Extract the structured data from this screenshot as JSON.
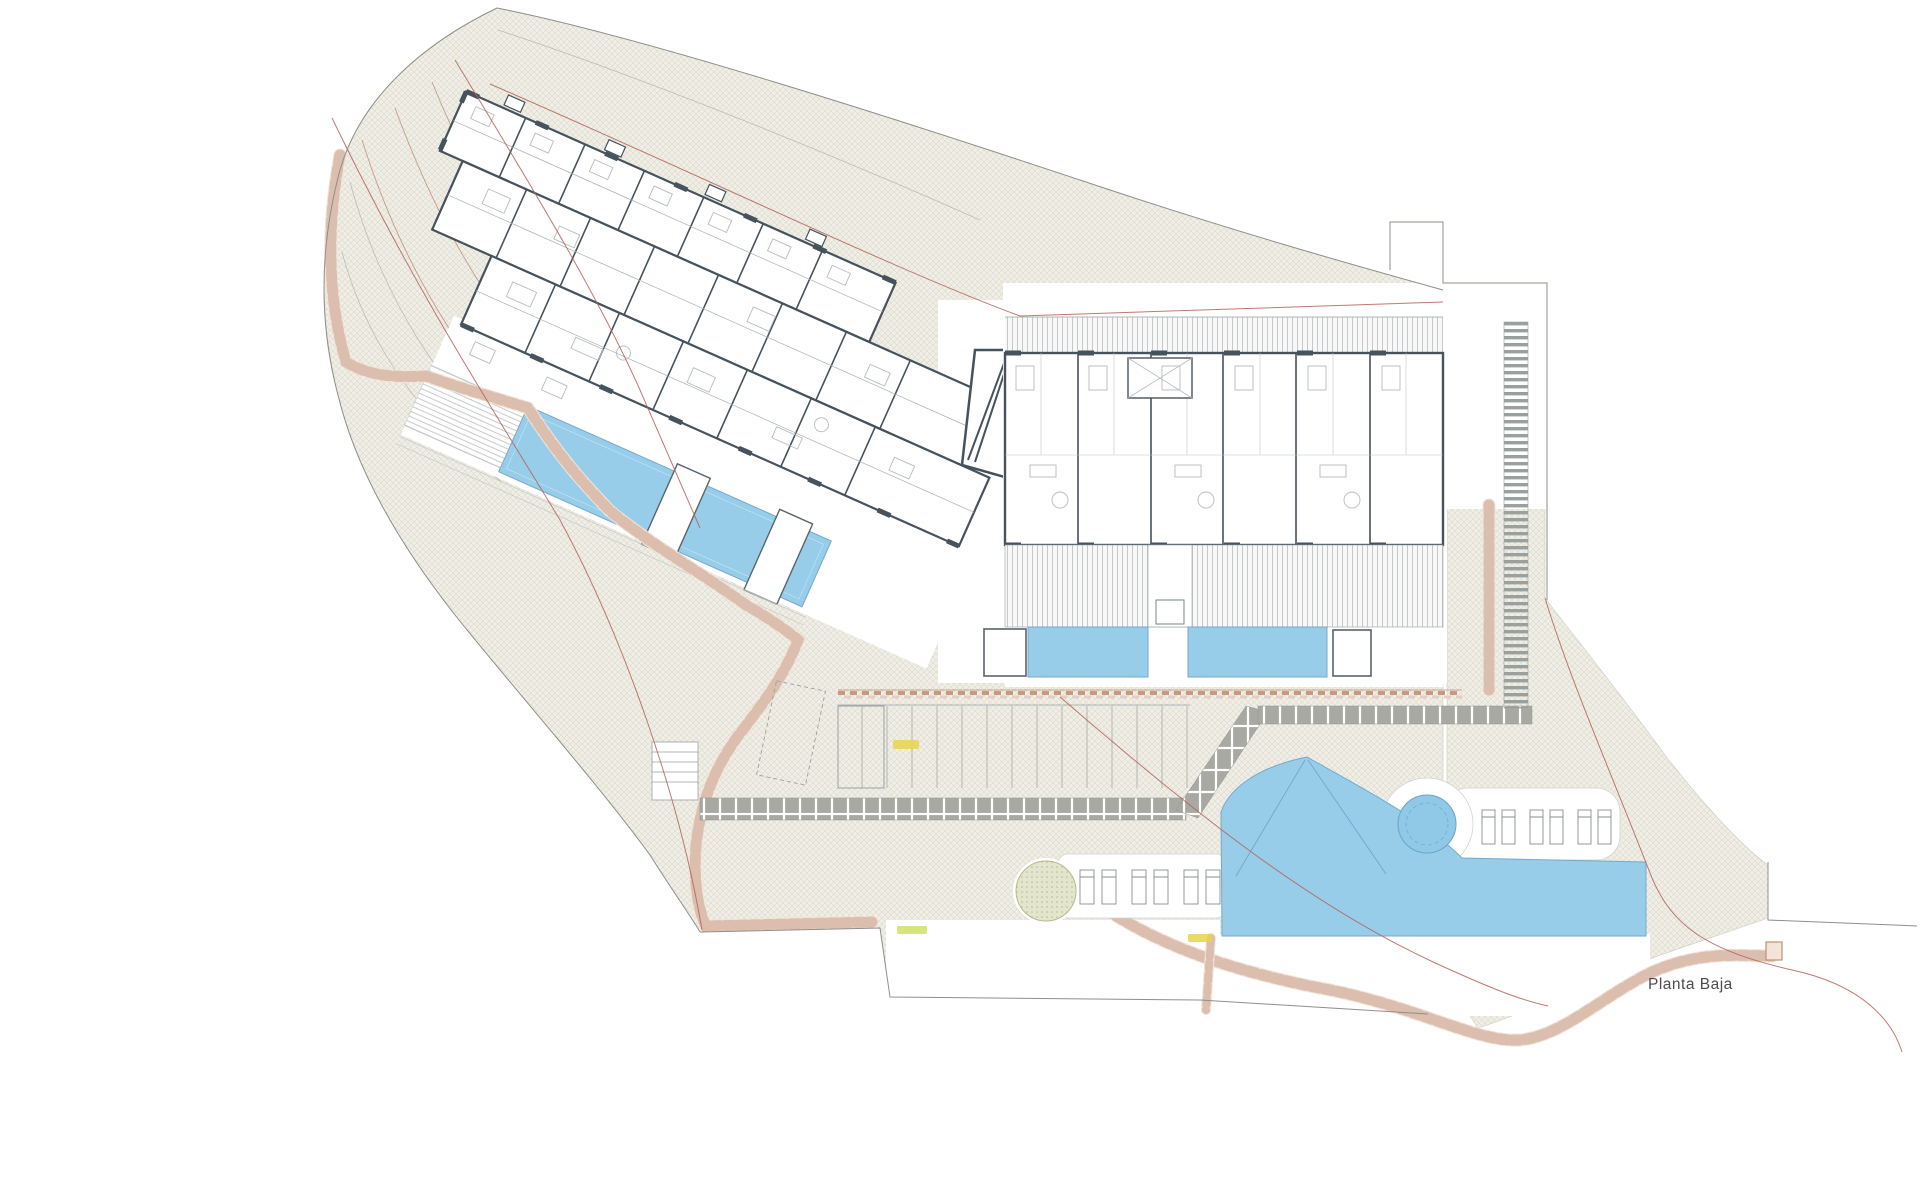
{
  "plan": {
    "label": "Planta Baja"
  },
  "colors": {
    "pool_blue": "#97cde9",
    "pool_edge": "#74aacb",
    "hatch_background": "#f0efe7",
    "hatch_line": "#dcd9c9",
    "wall_dark": "#46525c",
    "stone_terracotta": "#bf9078",
    "stone_fill": "#f2e4d9",
    "paver_gray": "#a9a9a4",
    "boundary_red": "#b4635a",
    "contour_brown": "#c49a8c",
    "tree_green": "#e3e6cc",
    "marker_yellow": "#e8d44d",
    "title_gray": "#4d4d4d"
  }
}
